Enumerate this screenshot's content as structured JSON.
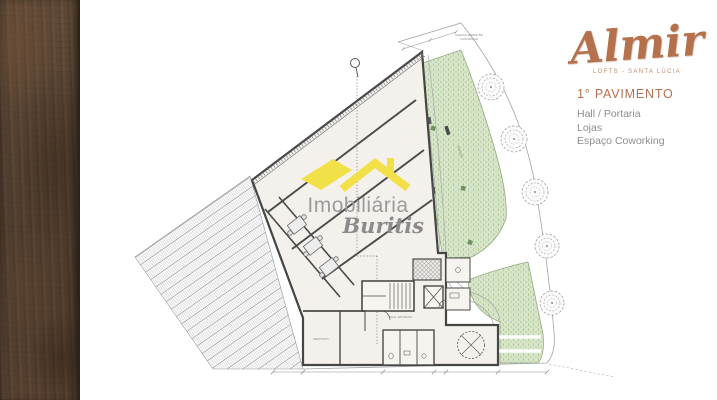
{
  "branding": {
    "logo_text": "Almir",
    "logo_subtitle": "LOFTS - SANTA LÚCIA",
    "accent_color": "#b5714f"
  },
  "info_panel": {
    "title": "1° PAVIMENTO",
    "items": [
      "Hall / Portaria",
      "Lojas",
      "Espaço Coworking"
    ]
  },
  "watermark": {
    "line1": "Imobiliária",
    "line2": "Buritis",
    "roof_color": "#f2e049"
  },
  "plan": {
    "labels": {
      "access1": "ACESSO PEDESTRE",
      "access2": "COWORKING",
      "hall": "HALL ENTRADA",
      "deposito": "DEPÓSITO",
      "jardim": "JARDIM"
    },
    "colors": {
      "floor": "#f4f1ec",
      "wall": "#4a4a4a",
      "garden_fill": "#d7e5c8",
      "garden_dot": "#9dbd85",
      "stripe_brown": "#54402f"
    }
  }
}
